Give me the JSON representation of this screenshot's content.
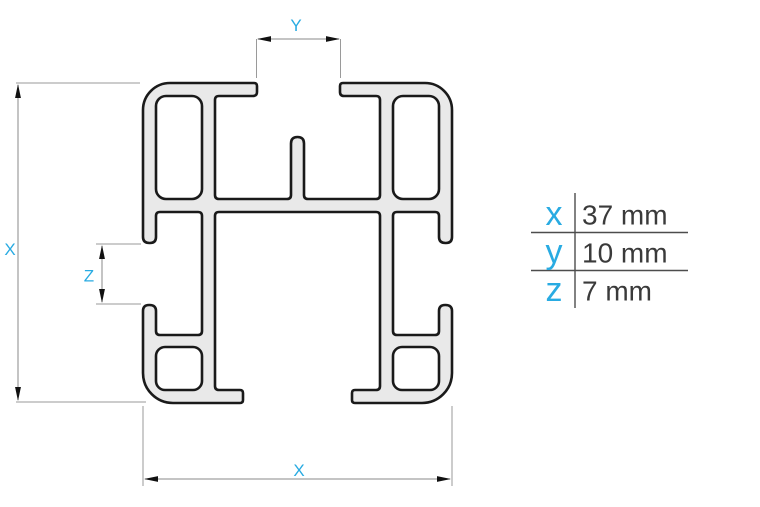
{
  "diagram": {
    "labels": {
      "x_vertical": "X",
      "y_top": "Y",
      "z_side": "Z",
      "x_bottom": "X"
    },
    "colors": {
      "accent": "#29abe2",
      "profile_fill": "#e9e9e9",
      "profile_outline": "#1a1a1a",
      "dimension_line": "#8a8a8a",
      "legend_text": "#3a3a3a"
    }
  },
  "legend": {
    "rows": [
      {
        "label": "x",
        "value": "37 mm"
      },
      {
        "label": "y",
        "value": "10 mm"
      },
      {
        "label": "z",
        "value": "7 mm"
      }
    ]
  }
}
